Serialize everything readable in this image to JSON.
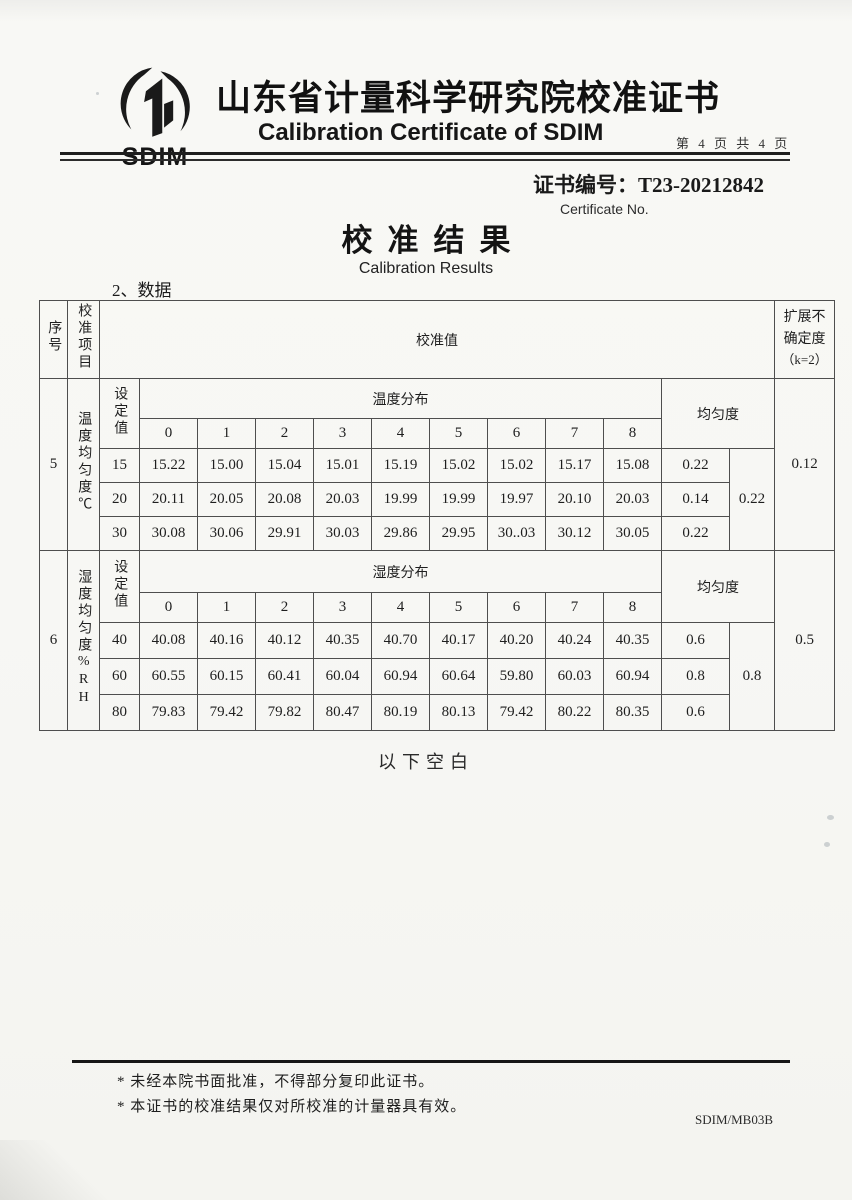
{
  "header": {
    "logo_text": "SDIM",
    "title_cn": "山东省计量科学研究院校准证书",
    "title_en": "Calibration Certificate of SDIM",
    "page_label": "第 4 页 共 4 页",
    "cert_no": "证书编号：T23-20212842",
    "cert_no_en": "Certificate No."
  },
  "results": {
    "title_cn": "校准结果",
    "title_en": "Calibration Results",
    "data_heading": "2、数据"
  },
  "table": {
    "headers": {
      "seq": "序号",
      "item": "校准项目",
      "value": "校准值",
      "uncertainty": "扩展不确定度",
      "uncertainty_k": "（k=2）",
      "setpoint": "设定值",
      "uniformity": "均匀度"
    },
    "temperature": {
      "seq": "5",
      "item": "温度均匀度℃",
      "dist_label": "温度分布",
      "points": [
        "0",
        "1",
        "2",
        "3",
        "4",
        "5",
        "6",
        "7",
        "8"
      ],
      "rows": [
        {
          "setpoint": "15",
          "values": [
            "15.22",
            "15.00",
            "15.04",
            "15.01",
            "15.19",
            "15.02",
            "15.02",
            "15.17",
            "15.08"
          ],
          "uniformity": "0.22"
        },
        {
          "setpoint": "20",
          "values": [
            "20.11",
            "20.05",
            "20.08",
            "20.03",
            "19.99",
            "19.99",
            "19.97",
            "20.10",
            "20.03"
          ],
          "uniformity": "0.14"
        },
        {
          "setpoint": "30",
          "values": [
            "30.08",
            "30.06",
            "29.91",
            "30.03",
            "29.86",
            "29.95",
            "30..03",
            "30.12",
            "30.05"
          ],
          "uniformity": "0.22"
        }
      ],
      "overall_uniformity": "0.22",
      "uncertainty": "0.12"
    },
    "humidity": {
      "seq": "6",
      "item": "湿度均匀度%RH",
      "dist_label": "湿度分布",
      "points": [
        "0",
        "1",
        "2",
        "3",
        "4",
        "5",
        "6",
        "7",
        "8"
      ],
      "rows": [
        {
          "setpoint": "40",
          "values": [
            "40.08",
            "40.16",
            "40.12",
            "40.35",
            "40.70",
            "40.17",
            "40.20",
            "40.24",
            "40.35"
          ],
          "uniformity": "0.6"
        },
        {
          "setpoint": "60",
          "values": [
            "60.55",
            "60.15",
            "60.41",
            "60.04",
            "60.94",
            "60.64",
            "59.80",
            "60.03",
            "60.94"
          ],
          "uniformity": "0.8"
        },
        {
          "setpoint": "80",
          "values": [
            "79.83",
            "79.42",
            "79.82",
            "80.47",
            "80.19",
            "80.13",
            "79.42",
            "80.22",
            "80.35"
          ],
          "uniformity": "0.6"
        }
      ],
      "overall_uniformity": "0.8",
      "uncertainty": "0.5"
    }
  },
  "body_note": {
    "blank_label": "以下空白"
  },
  "footer": {
    "notes": [
      "* 未经本院书面批准，不得部分复印此证书。",
      "* 本证书的校准结果仅对所校准的计量器具有效。"
    ],
    "form_code": "SDIM/MB03B"
  }
}
